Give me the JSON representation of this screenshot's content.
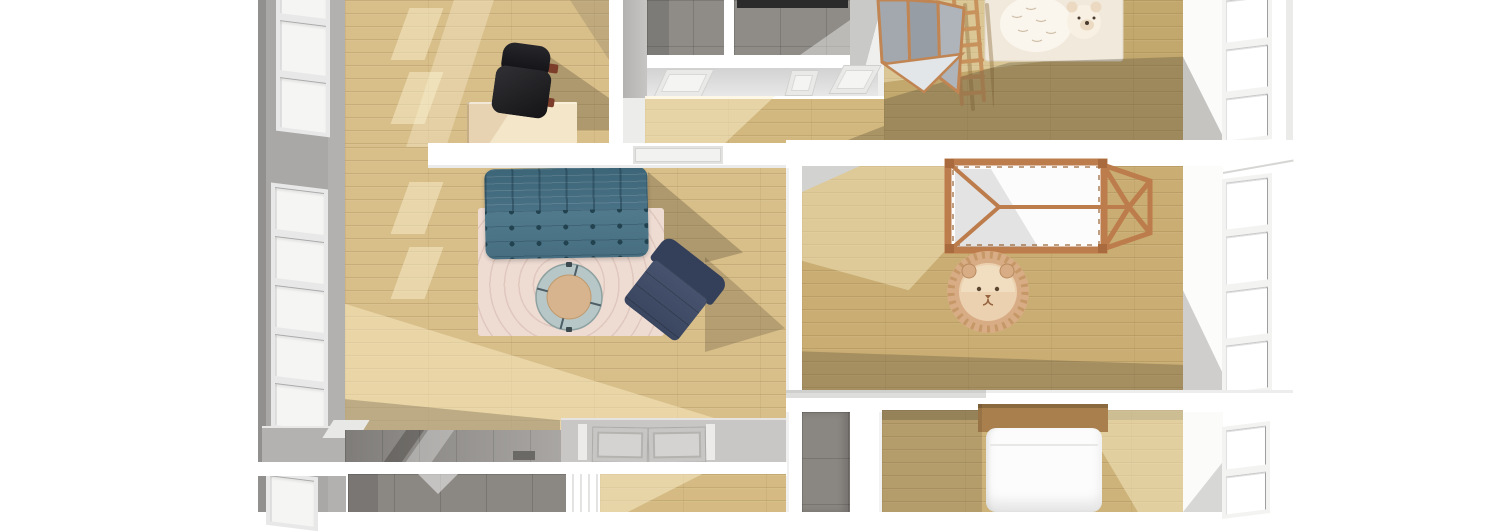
{
  "scene": {
    "type": "floor-plan-3d-top-view"
  },
  "walls": {
    "exterior_grey": "#a9a8a6",
    "exterior_edge": "#8f8e8c",
    "interior_white": "#ffffff",
    "shade_grey": "#d2d2d0",
    "dark_strip": "#2b2b2b",
    "ledge_grey": "#b3b2b0"
  },
  "windows": {
    "frame_left": "#e8e8e8",
    "pane_left": "#f5f5f4",
    "frame_right": "#f3f3f2",
    "pane_right": "#ffffff"
  },
  "rooms": {
    "office": {
      "floor": "#d8be89"
    },
    "living_room": {
      "floor": "#d8be89"
    },
    "hallway_upper": {
      "floor": "#d2b87f"
    },
    "bathroom_a": {
      "floor": "#8f8c88"
    },
    "bathroom_b": {
      "floor": "#8f8c88"
    },
    "nursery": {
      "floor": "#c3a86d"
    },
    "kids_bedroom": {
      "floor": "#c9ad72"
    },
    "bedroom": {
      "floor": "#cdb379"
    },
    "hallway": {
      "floor": "#9b9894"
    },
    "entry": {
      "floor": "#c8c7c5"
    },
    "bathroom_c": {
      "floor": "#8b8783"
    },
    "lower_room": {
      "floor": "#d5bb83"
    },
    "corridor": {
      "floor": "#8a8682"
    }
  },
  "furniture": {
    "sofa": {
      "color": "#4a7184"
    },
    "armchair": {
      "color": "#3e4a64"
    },
    "area_rug": {
      "color": "#eedcd3"
    },
    "coffee_table": {
      "ring": "#b7c7c7",
      "top": "#d7b48e"
    },
    "desk": {
      "color": "#e7d3b1"
    },
    "office_chair": {
      "color": "#1a1a1e",
      "accent": "#7c3e2a"
    },
    "canopy_bed": {
      "frame": "#bd7c4b",
      "mattress": "#fcfcfc"
    },
    "lion_rug": {
      "base": "#d8ad85",
      "face": "#ebd1b0"
    },
    "bear_rug": {
      "base": "#f1e9dc",
      "bear": "#faf6ee"
    },
    "folding_screen": {
      "panel": "#a2a8ae",
      "frame": "#c08552"
    },
    "wall_bars": {
      "color": "#c8925c"
    },
    "bed": {
      "headboard": "#a9804d",
      "mattress": "#fcfcfc"
    },
    "door_mat": {
      "color": "#6b6966"
    }
  }
}
